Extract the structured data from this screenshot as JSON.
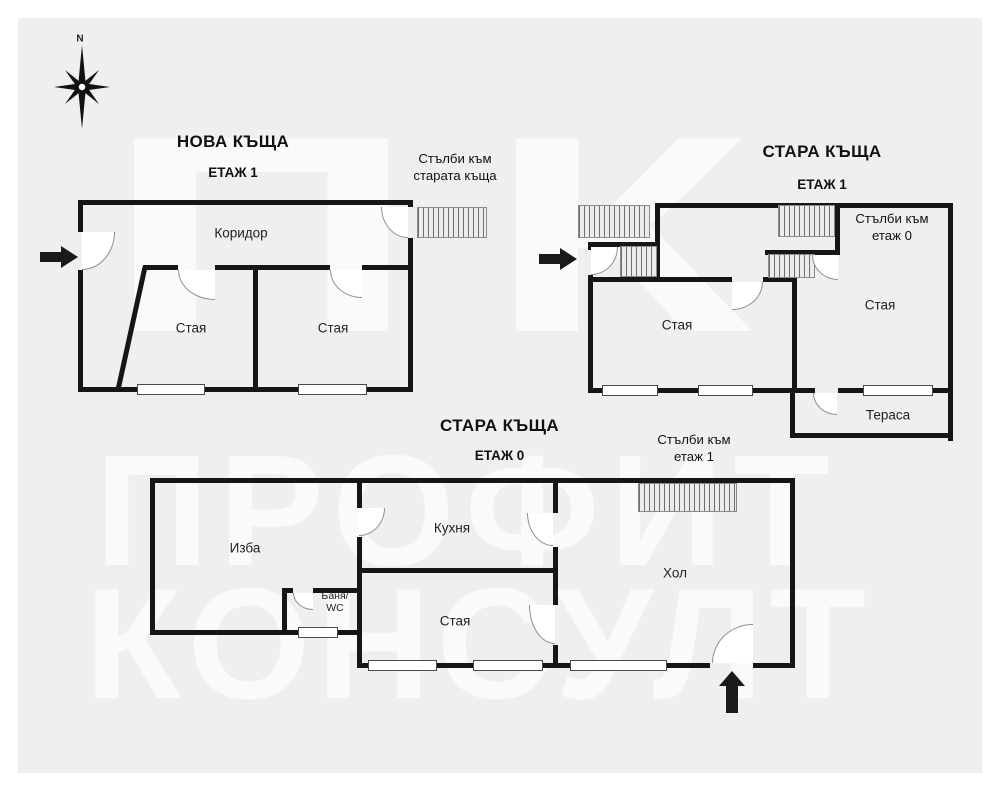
{
  "colors": {
    "page_background": "#ffffff",
    "board_background": "#efefef",
    "wall": "#161616",
    "watermark_text": "rgba(255,255,255,0.65)"
  },
  "icons": {
    "compass": "compass-rose-8-point",
    "entrance_arrows": "solid-black-arrow",
    "stairs": "hatched-stairs-rectangle",
    "doors": "quarter-circle-door-swing",
    "windows": "white-rectangle-window"
  },
  "compass": {
    "north_label": "N"
  },
  "watermark": {
    "logo_text": "ПК",
    "line1": "ПРОФИТ",
    "line2": "КОНСУЛТ"
  },
  "new_house": {
    "title": "НОВА КЪЩА",
    "floor": "ЕТАЖ 1",
    "stairs_note": {
      "line1": "Стълби към",
      "line2": "старата къща"
    },
    "rooms": {
      "corridor": "Коридор",
      "room_left": "Стая",
      "room_right": "Стая"
    }
  },
  "old_house_floor1": {
    "title": "СТАРА КЪЩА",
    "floor": "ЕТАЖ 1",
    "stairs_note": {
      "line1": "Стълби към",
      "line2": "етаж 0"
    },
    "rooms": {
      "room_left": "Стая",
      "room_right": "Стая",
      "terrace": "Тераса"
    }
  },
  "old_house_floor0": {
    "title": "СТАРА КЪЩА",
    "floor": "ЕТАЖ 0",
    "stairs_note": {
      "line1": "Стълби към",
      "line2": "етаж 1"
    },
    "rooms": {
      "cellar": "Изба",
      "kitchen": "Кухня",
      "bath": {
        "line1": "Баня/",
        "line2": "WC"
      },
      "room": "Стая",
      "hall": "Хол"
    }
  }
}
